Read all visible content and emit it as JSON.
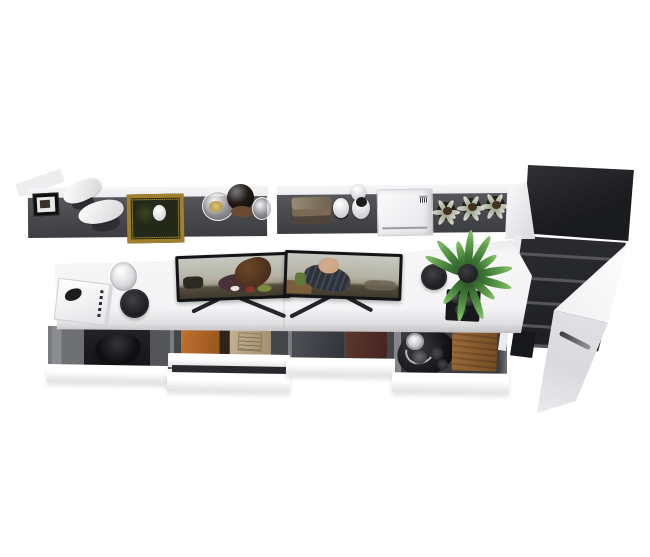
{
  "meta": {
    "description": "Top-down 3D product render of a white modular workstation: wall shelf with decor, dual-monitor desk with four open drawers, and a tall dark wardrobe with its white door open on the right.",
    "visible_text": "none (no legible text in the render)"
  },
  "palette": {
    "bg": "#ffffff",
    "shelf-light": "#ececee",
    "shelf-dark": "#4b4c50",
    "cab-top-1": "#1a1b1e",
    "cab-top-2": "#303136",
    "cab-int-1": "#2b2c30",
    "cab-int-2": "#1d1e21",
    "cab-line": "#55565b",
    "door-hi": "#ffffff",
    "door-mid": "#ececef",
    "door-handle": "#3a3a3f",
    "desk-top": "#f6f6f7",
    "desk-edge": "#c6c6c9",
    "bezel": "#131416",
    "scr-sky": "#c6c9c1",
    "scr-mid": "#a39c8a",
    "scr-table": "#544c3b",
    "person-maroon": "#4a3038",
    "person-navy": "#2e323b",
    "skin": "#c9a184",
    "hair": "#4a2f1c",
    "green-dark": "#23491f",
    "green-mid": "#3f7a36",
    "green-light": "#8cc573",
    "pot-dark": "#1e1f23",
    "orange": "#c1722e",
    "orange-dark": "#96541e",
    "tan": "#c3b190",
    "tan-dark": "#a08e6c",
    "graybook": "#4e5057",
    "maroonbook": "#5d372c",
    "wood": "#9a6a38",
    "wood-dark": "#744c24",
    "gold": "#a0802c",
    "tray-green": "#232818",
    "black-obj": "#18181b",
    "silver": "#c9cacd",
    "drawer-wall": "#7b7c7f",
    "drawer-mid": "#454649",
    "front-1": "#ffffff",
    "front-2": "#e2e2e4"
  },
  "objects": {
    "shelf_left": {
      "label": "Wall shelf - left section"
    },
    "shelf_right": {
      "label": "Wall shelf - right section"
    },
    "framed_photo": {
      "label": "Small framed photo"
    },
    "leaf_sculpture": {
      "label": "White leaf sculpture"
    },
    "ornate_tray": {
      "label": "Gold ornate tray with cup"
    },
    "glass_bowl": {
      "label": "Glass bowl with snacks"
    },
    "dark_vase": {
      "label": "Dark glass vase with saucer"
    },
    "glass_cup_shelf": {
      "label": "Glass cup"
    },
    "book_stack": {
      "label": "Stack of rustic books"
    },
    "egg_decor": {
      "label": "Egg-shaped ornaments"
    },
    "printer": {
      "label": "White printer"
    },
    "succulents": {
      "label": "Three potted succulents"
    },
    "desk": {
      "label": "White desk top"
    },
    "magazine": {
      "label": "Magazine with bird cover"
    },
    "glass_cup_desk": {
      "label": "Glass cup"
    },
    "speaker_left": {
      "label": "Round black speaker"
    },
    "speaker_right": {
      "label": "Round black speaker"
    },
    "monitors": {
      "label": "Dual monitors playing a cafe movie scene"
    },
    "fern": {
      "label": "Potted fern"
    },
    "candle_tray": {
      "label": "Black tray with three candles"
    },
    "drawer_controller": {
      "label": "Open drawer with game controller"
    },
    "drawer_books": {
      "label": "Open drawer with orange and tan binders"
    },
    "drawer_files": {
      "label": "Open drawer with gray and maroon folders"
    },
    "drawer_headphones": {
      "label": "Open drawer with headphone tray and wooden box"
    },
    "wardrobe": {
      "label": "Tall dark wardrobe with interior shelves"
    },
    "wardrobe_door": {
      "label": "Open white wardrobe door"
    }
  }
}
